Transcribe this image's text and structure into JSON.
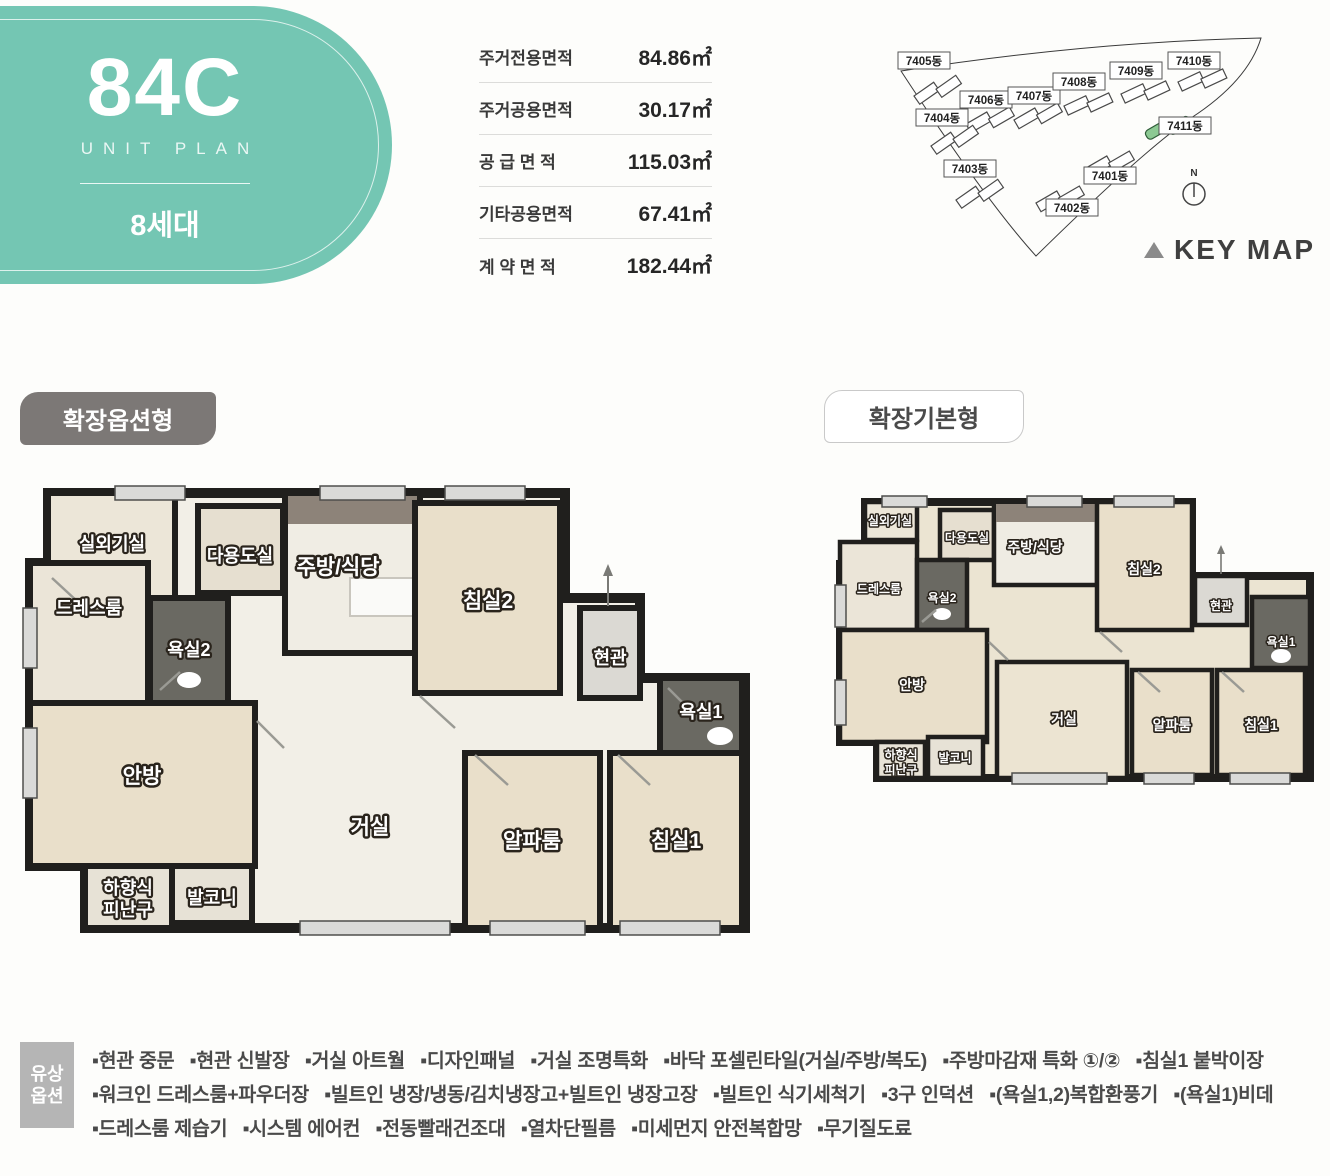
{
  "unit": {
    "code": "84C",
    "subtitle": "UNIT PLAN",
    "households": "8세대"
  },
  "area_table": {
    "rows": [
      {
        "label": "주거전용면적",
        "value": "84.86㎡"
      },
      {
        "label": "주거공용면적",
        "value": "30.17㎡"
      },
      {
        "label": "공 급 면 적",
        "value": "115.03㎡"
      },
      {
        "label": "기타공용면적",
        "value": "67.41㎡"
      },
      {
        "label": "계 약 면 적",
        "value": "182.44㎡"
      }
    ]
  },
  "keymap": {
    "buildings": [
      "7405동",
      "7406동",
      "7407동",
      "7408동",
      "7409동",
      "7410동",
      "7404동",
      "7403동",
      "7402동",
      "7401동",
      "7411동"
    ],
    "highlighted_building": "7411동",
    "compass_n": "N",
    "triangle_icon": "▲",
    "label": "KEY MAP"
  },
  "plan_labels": {
    "option": "확장옵션형",
    "basic": "확장기본형"
  },
  "rooms": {
    "outdoor_unit": "실외기실",
    "utility": "다용도실",
    "kitchen_dining": "주방/식당",
    "bedroom2": "침실2",
    "entrance": "현관",
    "bathroom1": "욕실1",
    "dressroom": "드레스룸",
    "bathroom2": "욕실2",
    "master_bedroom": "안방",
    "living_room": "거실",
    "alpha_room": "알파룸",
    "bedroom1": "침실1",
    "escape_hatch_line1": "하향식",
    "escape_hatch_line2": "피난구",
    "balcony": "발코니"
  },
  "options": {
    "title_line1": "유상",
    "title_line2": "옵션",
    "lines": [
      "▪현관 중문   ▪현관 신발장   ▪거실 아트월   ▪디자인패널   ▪거실 조명특화   ▪바닥 포셀린타일(거실/주방/복도)   ▪주방마감재 특화 ①/②   ▪침실1 붙박이장",
      "▪워크인 드레스룸+파우더장   ▪빌트인 냉장/냉동/김치냉장고+빌트인 냉장고장   ▪빌트인 식기세척기   ▪3구 인덕션   ▪(욕실1,2)복합환풍기   ▪(욕실1)비데",
      "▪드레스룸 제습기   ▪시스템 에어컨   ▪전동빨래건조대   ▪열차단필름   ▪미세먼지 안전복합망   ▪무기질도료"
    ]
  },
  "colors": {
    "accent_teal": "#74c6b3",
    "badge_gray": "#7c7876",
    "highlight_green": "#8cc993"
  }
}
